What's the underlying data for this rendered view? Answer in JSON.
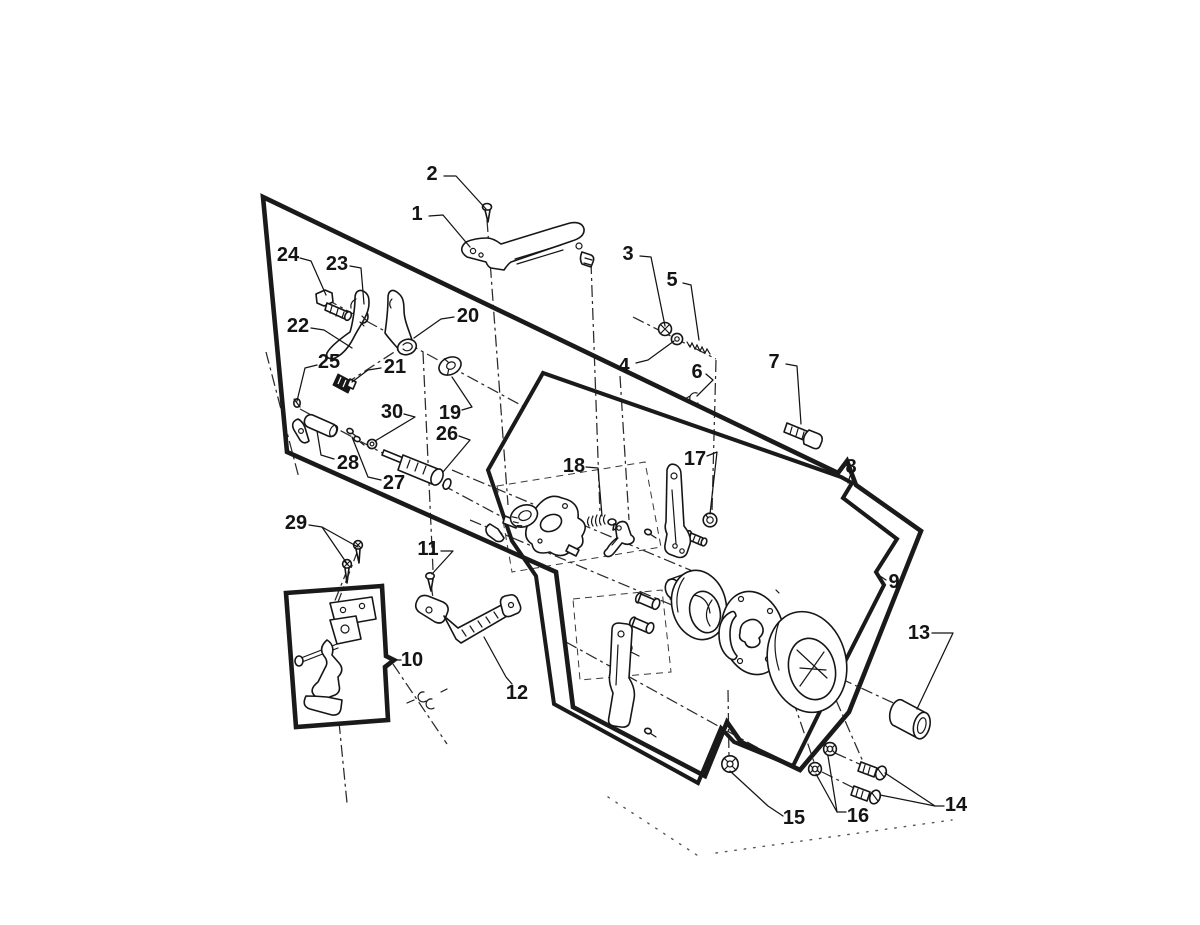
{
  "figure": {
    "kind": "exploded-parts-diagram",
    "background": "#ffffff",
    "ink": "#161616",
    "label_font_size": 20
  },
  "callouts": [
    {
      "label": "1",
      "x": 417,
      "y": 214,
      "leaders": [
        [
          [
            429,
            216
          ],
          [
            443,
            215
          ],
          [
            470,
            247
          ]
        ]
      ]
    },
    {
      "label": "2",
      "x": 432,
      "y": 174,
      "leaders": [
        [
          [
            444,
            176
          ],
          [
            456,
            176
          ],
          [
            486,
            209
          ]
        ]
      ]
    },
    {
      "label": "3",
      "x": 628,
      "y": 254,
      "leaders": [
        [
          [
            640,
            256
          ],
          [
            651,
            257
          ],
          [
            665,
            326
          ]
        ]
      ]
    },
    {
      "label": "4",
      "x": 624,
      "y": 366,
      "leaders": [
        [
          [
            636,
            363
          ],
          [
            648,
            360
          ],
          [
            674,
            341
          ]
        ]
      ]
    },
    {
      "label": "5",
      "x": 672,
      "y": 280,
      "leaders": [
        [
          [
            683,
            283
          ],
          [
            691,
            285
          ],
          [
            699,
            340
          ]
        ]
      ]
    },
    {
      "label": "6",
      "x": 697,
      "y": 372,
      "leaders": [
        [
          [
            706,
            374
          ],
          [
            713,
            380
          ],
          [
            697,
            396
          ]
        ]
      ]
    },
    {
      "label": "7",
      "x": 774,
      "y": 362,
      "leaders": [
        [
          [
            786,
            364
          ],
          [
            797,
            366
          ],
          [
            801,
            424
          ]
        ]
      ]
    },
    {
      "label": "8",
      "x": 851,
      "y": 467,
      "leaders": [
        [
          [
            850,
            476
          ],
          [
            848,
            483
          ]
        ]
      ]
    },
    {
      "label": "9",
      "x": 894,
      "y": 582,
      "leaders": [
        [
          [
            886,
            580
          ],
          [
            880,
            576
          ]
        ]
      ]
    },
    {
      "label": "10",
      "x": 412,
      "y": 660,
      "leaders": [
        [
          [
            401,
            660
          ],
          [
            394,
            660
          ]
        ]
      ]
    },
    {
      "label": "11",
      "x": 428,
      "y": 549,
      "leaders": [
        [
          [
            441,
            551
          ],
          [
            453,
            551
          ],
          [
            432,
            574
          ]
        ]
      ]
    },
    {
      "label": "12",
      "x": 517,
      "y": 693,
      "leaders": [
        [
          [
            512,
            684
          ],
          [
            506,
            677
          ],
          [
            484,
            637
          ]
        ]
      ]
    },
    {
      "label": "13",
      "x": 919,
      "y": 633,
      "leaders": [
        [
          [
            932,
            633
          ],
          [
            953,
            633
          ],
          [
            917,
            709
          ]
        ]
      ]
    },
    {
      "label": "14",
      "x": 956,
      "y": 805,
      "leaders": [
        [
          [
            944,
            806
          ],
          [
            935,
            806
          ],
          [
            885,
            773
          ]
        ],
        [
          [
            935,
            806
          ],
          [
            880,
            795
          ]
        ]
      ]
    },
    {
      "label": "15",
      "x": 794,
      "y": 818,
      "leaders": [
        [
          [
            783,
            816
          ],
          [
            768,
            806
          ],
          [
            730,
            771
          ]
        ]
      ]
    },
    {
      "label": "16",
      "x": 858,
      "y": 816,
      "leaders": [
        [
          [
            846,
            812
          ],
          [
            837,
            812
          ],
          [
            828,
            756
          ]
        ],
        [
          [
            837,
            812
          ],
          [
            816,
            774
          ]
        ]
      ]
    },
    {
      "label": "17",
      "x": 695,
      "y": 459,
      "leaders": [
        [
          [
            707,
            456
          ],
          [
            717,
            452
          ],
          [
            710,
            514
          ]
        ]
      ]
    },
    {
      "label": "18",
      "x": 574,
      "y": 466,
      "leaders": [
        [
          [
            586,
            467
          ],
          [
            598,
            468
          ],
          [
            602,
            516
          ]
        ]
      ]
    },
    {
      "label": "19",
      "x": 450,
      "y": 413,
      "leaders": [
        [
          [
            462,
            410
          ],
          [
            472,
            407
          ],
          [
            452,
            377
          ]
        ]
      ]
    },
    {
      "label": "20",
      "x": 468,
      "y": 316,
      "leaders": [
        [
          [
            454,
            317
          ],
          [
            441,
            319
          ],
          [
            414,
            338
          ]
        ]
      ]
    },
    {
      "label": "21",
      "x": 395,
      "y": 367,
      "leaders": [
        [
          [
            381,
            368
          ],
          [
            368,
            370
          ],
          [
            352,
            382
          ]
        ]
      ]
    },
    {
      "label": "22",
      "x": 298,
      "y": 326,
      "leaders": [
        [
          [
            311,
            328
          ],
          [
            324,
            330
          ],
          [
            352,
            348
          ]
        ]
      ]
    },
    {
      "label": "23",
      "x": 337,
      "y": 264,
      "leaders": [
        [
          [
            350,
            266
          ],
          [
            361,
            268
          ],
          [
            364,
            304
          ]
        ]
      ]
    },
    {
      "label": "24",
      "x": 288,
      "y": 255,
      "leaders": [
        [
          [
            300,
            258
          ],
          [
            311,
            261
          ],
          [
            326,
            295
          ]
        ]
      ]
    },
    {
      "label": "25",
      "x": 329,
      "y": 362,
      "leaders": [
        [
          [
            317,
            365
          ],
          [
            305,
            368
          ],
          [
            297,
            401
          ]
        ]
      ]
    },
    {
      "label": "26",
      "x": 447,
      "y": 434,
      "leaders": [
        [
          [
            459,
            436
          ],
          [
            470,
            440
          ],
          [
            443,
            472
          ]
        ]
      ]
    },
    {
      "label": "27",
      "x": 394,
      "y": 483,
      "leaders": [
        [
          [
            381,
            480
          ],
          [
            368,
            477
          ],
          [
            352,
            437
          ]
        ]
      ]
    },
    {
      "label": "28",
      "x": 348,
      "y": 463,
      "leaders": [
        [
          [
            334,
            459
          ],
          [
            321,
            455
          ],
          [
            317,
            431
          ]
        ]
      ]
    },
    {
      "label": "29",
      "x": 296,
      "y": 523,
      "leaders": [
        [
          [
            309,
            525
          ],
          [
            322,
            527
          ],
          [
            358,
            547
          ]
        ],
        [
          [
            322,
            527
          ],
          [
            348,
            565
          ]
        ]
      ]
    },
    {
      "label": "30",
      "x": 392,
      "y": 412,
      "leaders": [
        [
          [
            404,
            414
          ],
          [
            415,
            417
          ],
          [
            375,
            441
          ]
        ]
      ]
    }
  ]
}
